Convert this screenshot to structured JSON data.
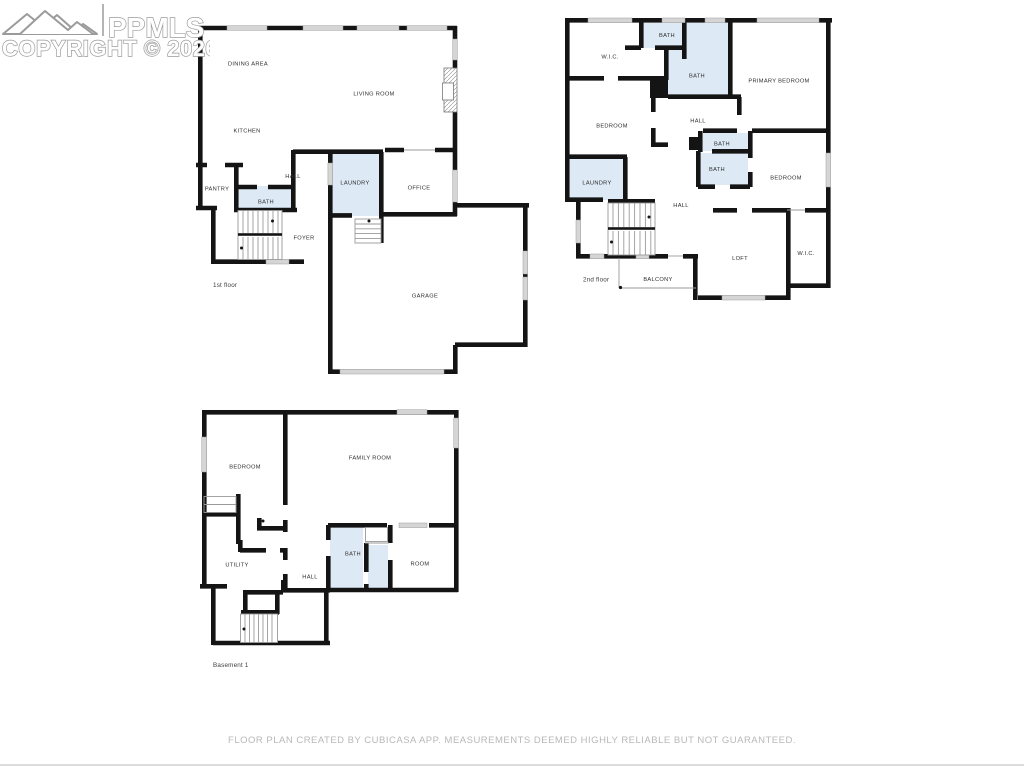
{
  "watermark": {
    "brand": "PPMLS",
    "copyright": "COPYRIGHT © 2026"
  },
  "footer": {
    "disclaimer": "FLOOR PLAN CREATED BY CUBICASA APP. MEASUREMENTS DEEMED HIGHLY RELIABLE BUT NOT GUARANTEED."
  },
  "colors": {
    "wall": "#141414",
    "wet_room_fill": "#dde9f4",
    "window_fill": "#d5d5d5",
    "window_edge": "#9e9e9e",
    "thin_line": "#9a9a9a",
    "room_label": "#2e2e2e",
    "floor_label": "#3d3d3d",
    "watermark_outline": "#9b9b9b",
    "footer_text": "#b8b8b8"
  },
  "floors": {
    "first": {
      "name": "1st floor",
      "rooms": {
        "dining": "DINING AREA",
        "living": "LIVING ROOM",
        "kitchen": "KITCHEN",
        "pantry": "PANTRY",
        "hall": "HALL",
        "bath": "BATH",
        "laundry": "LAUNDRY",
        "office": "OFFICE",
        "foyer": "FOYER",
        "garage": "GARAGE"
      }
    },
    "second": {
      "name": "2nd floor",
      "rooms": {
        "wic_top": "W.I.C.",
        "bath_small": "BATH",
        "bath_primary": "BATH",
        "primary_bedroom": "PRIMARY BEDROOM",
        "bedroom_left": "BEDROOM",
        "hall_top": "HALL",
        "bath_mid_top": "BATH",
        "bath_mid": "BATH",
        "bedroom_right": "BEDROOM",
        "laundry": "LAUNDRY",
        "hall_lower": "HALL",
        "loft": "LOFT",
        "wic_right": "W.I.C.",
        "balcony": "BALCONY"
      }
    },
    "basement": {
      "name": "Basement 1",
      "rooms": {
        "bedroom": "BEDROOM",
        "family": "FAMILY ROOM",
        "utility": "UTILITY",
        "hall": "HALL",
        "bath": "BATH",
        "room": "ROOM"
      }
    }
  }
}
